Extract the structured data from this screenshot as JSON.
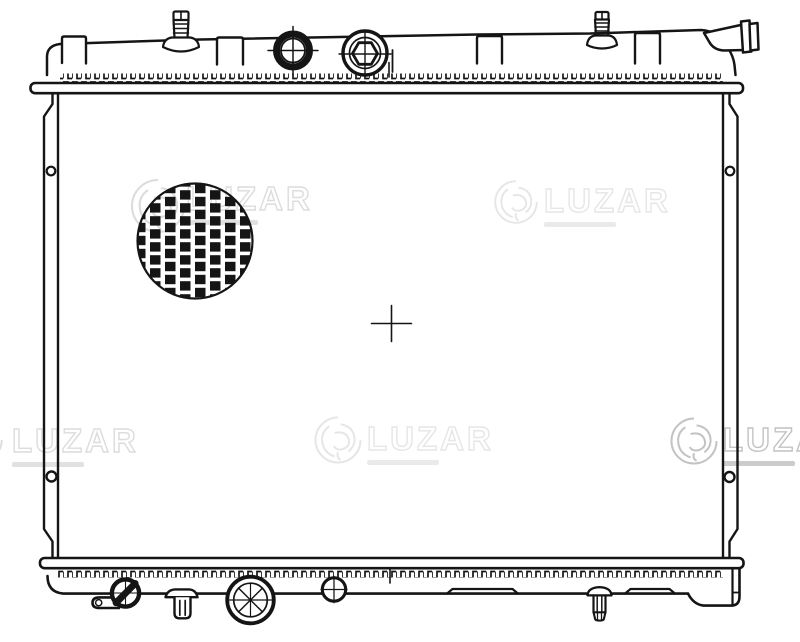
{
  "document": {
    "type": "technical-line-drawing",
    "subject": "automotive radiator, front view"
  },
  "colors": {
    "background": "#ffffff",
    "line": "#151515",
    "watermark_faint": "#e6e6e6",
    "watermark_medium": "#dcdcdc",
    "watermark_strong": "#c3c3c3"
  },
  "watermark": {
    "brand": "LUZAR"
  },
  "parts": [
    "top-tank",
    "filler-cap",
    "hex-plug-cap",
    "bleed-screw-left",
    "bleed-screw-right",
    "outlet-pipe",
    "pipe-flange",
    "mounting-tab",
    "top-header-serration",
    "top-header-plate",
    "core-face",
    "fin-detail-circle",
    "center-crosshair",
    "centerline-tick",
    "left-side-bracket",
    "right-side-bracket",
    "bracket-hole",
    "bottom-header-plate",
    "bottom-header-serration",
    "bottom-tank",
    "drain-plug",
    "drain-spout",
    "push-pin-fastener",
    "mounting-pin",
    "machined-boss",
    "cross-boss",
    "bottom-rib"
  ]
}
